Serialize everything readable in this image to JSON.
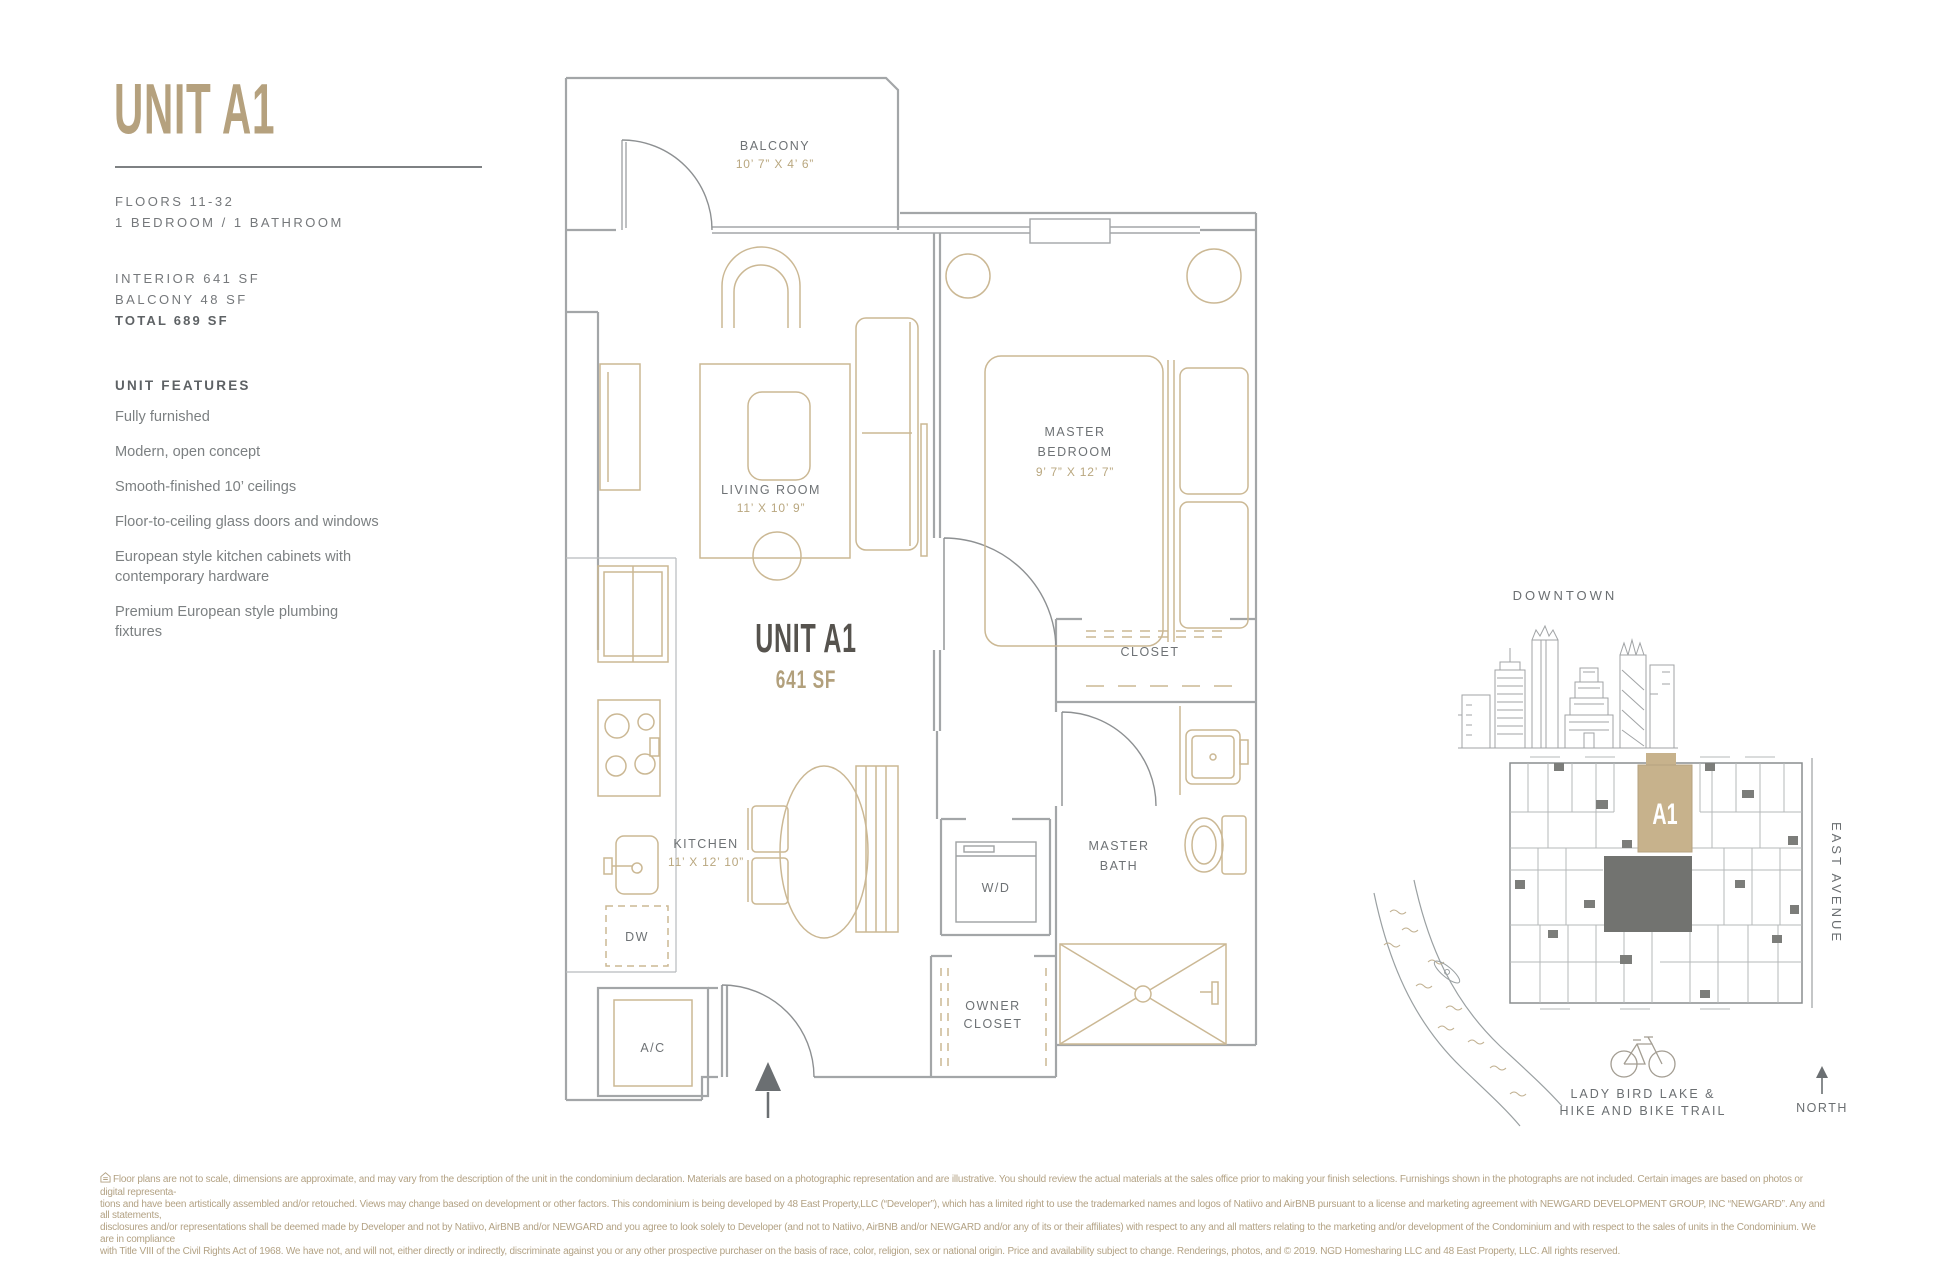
{
  "header": {
    "title": "UNIT A1",
    "floors": "FLOORS 11-32",
    "bed_bath": "1 BEDROOM / 1 BATHROOM",
    "interior": "INTERIOR 641 SF",
    "balcony": "BALCONY 48 SF",
    "total": "TOTAL 689 SF"
  },
  "features": {
    "heading": "UNIT FEATURES",
    "items": [
      "Fully furnished",
      "Modern, open concept",
      "Smooth-finished 10’ ceilings",
      "Floor-to-ceiling glass doors and windows",
      "European style kitchen cabinets with contemporary hardware",
      "Premium European style plumbing fixtures"
    ]
  },
  "floorplan": {
    "unit_label": "UNIT A1",
    "unit_area": "641 SF",
    "rooms": {
      "balcony": {
        "name": "BALCONY",
        "dims": "10’ 7” X 4’ 6”"
      },
      "living": {
        "name": "LIVING ROOM",
        "dims": "11’ X 10’ 9”"
      },
      "bedroom": {
        "name1": "MASTER",
        "name2": "BEDROOM",
        "dims": "9’ 7” X 12’ 7”"
      },
      "closet": "CLOSET",
      "kitchen": {
        "name": "KITCHEN",
        "dims": "11’ X 12’ 10”"
      },
      "wd": "W/D",
      "bath": {
        "name1": "MASTER",
        "name2": "BATH"
      },
      "owner_closet": {
        "name1": "OWNER",
        "name2": "CLOSET"
      },
      "dw": "DW",
      "ac": "A/C"
    }
  },
  "map": {
    "downtown": "DOWNTOWN",
    "unit_tag": "A1",
    "street": "EAST AVENUE",
    "lake_line1": "LADY BIRD LAKE &",
    "lake_line2": "HIKE AND BIKE TRAIL",
    "north": "NORTH"
  },
  "colors": {
    "gold": "#b5a17e",
    "wall_gray": "#a3a6a8",
    "furniture_tan": "#cbb894",
    "label_gray": "#6e7275",
    "site_highlight": "#c7b28c",
    "site_core": "#727370"
  },
  "disclaimer": {
    "lines": [
      "Floor plans are not to scale, dimensions are approximate, and may vary from the description of the unit in the condominium declaration. Materials are based on a photographic representation and are illustrative. You should review the actual materials at the sales office prior to making your finish selections. Furnishings shown in the photographs are not included. Certain images are based on photos or digital representa-",
      "tions and have been artistically assembled and/or retouched. Views may change based on development or other factors. This condominium is being developed by 48 East Property,LLC (“Developer”), which has a limited right to use the trademarked names and logos of Natiivo and AirBNB pursuant to a license and marketing agreement with NEWGARD DEVELOPMENT GROUP, INC “NEWGARD”. Any and all statements,",
      "disclosures and/or representations shall be deemed made by Developer and not by Natiivo, AirBNB and/or NEWGARD and you agree to look solely to Developer (and not to Natiivo, AirBNB and/or NEWGARD and/or any of its or their affiliates) with respect to any and all matters relating to the marketing and/or development of the Condominium and with respect to the sales of units in the Condominium. We are in compliance",
      "with Title VIII of the Civil Rights Act of 1968. We have not, and will not, either directly or indirectly, discriminate against you or any other prospective purchaser on the basis of race, color, religion, sex or national origin. Price and availability subject to change. Renderings, photos, and © 2019. NGD Homesharing LLC and 48 East Property, LLC. All rights reserved."
    ]
  }
}
